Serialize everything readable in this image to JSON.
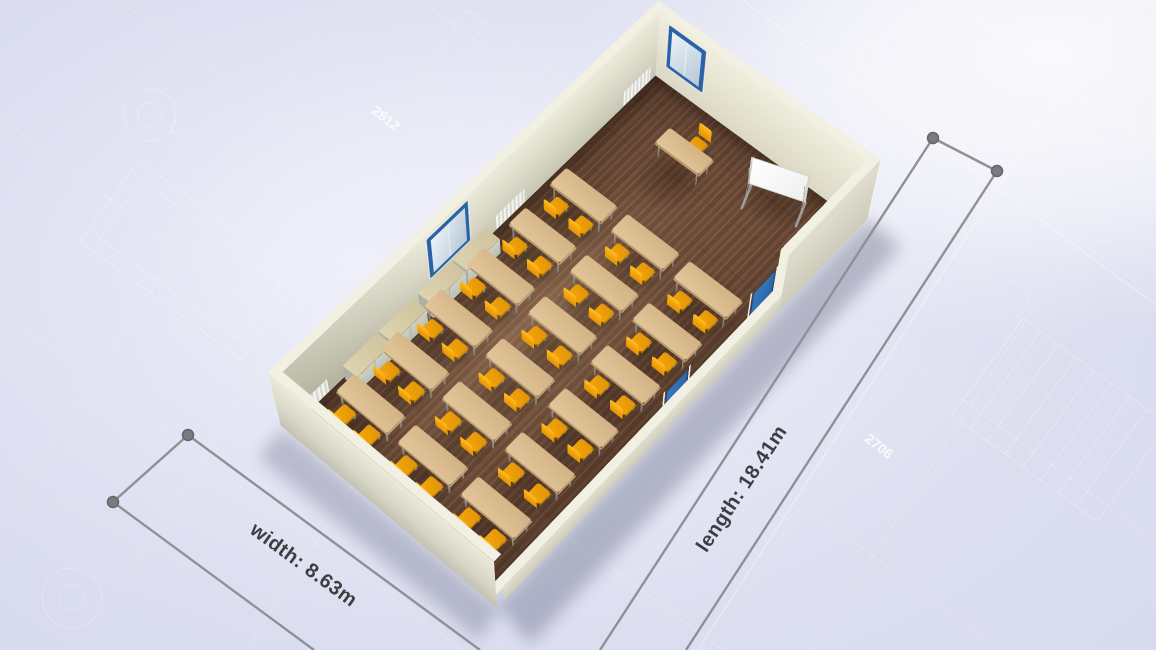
{
  "dimensions": {
    "width_label": "width: 8.63m",
    "length_label": "length: 18.41m"
  },
  "blueprint_numbers": [
    {
      "text": "2812"
    },
    {
      "text": "2706"
    }
  ],
  "annotation_style": {
    "line_color": "#8f9095",
    "marker_color": "#7a7b80",
    "text_color": "#3d3e42"
  },
  "room": {
    "type": "classroom",
    "floor": {
      "material": "wood",
      "color": "#6b4b38"
    },
    "walls": {
      "color": "#dedcca"
    },
    "windows": {
      "count": 2,
      "frame_color": "#2a62a8"
    },
    "doors": {
      "count": 2,
      "color": "#2e6bb0"
    },
    "radiators": {
      "count": 3,
      "color": "#ededea"
    },
    "furniture": {
      "student_desks": {
        "count": 18,
        "rows": 6,
        "columns": 3,
        "top_color": "#d8b98c"
      },
      "student_chairs": {
        "count": 36,
        "color": "#f7a60a"
      },
      "teacher_desk": {
        "count": 1,
        "top_color": "#d8b98c"
      },
      "teacher_chair": {
        "count": 1,
        "color": "#f7a60a"
      },
      "whiteboard": {
        "count": 1,
        "color": "#fbfbf9"
      },
      "storage_cabinets": {
        "count": 4,
        "top_color": "#d5c9a4",
        "body_color": "#c3c7ba"
      }
    }
  }
}
